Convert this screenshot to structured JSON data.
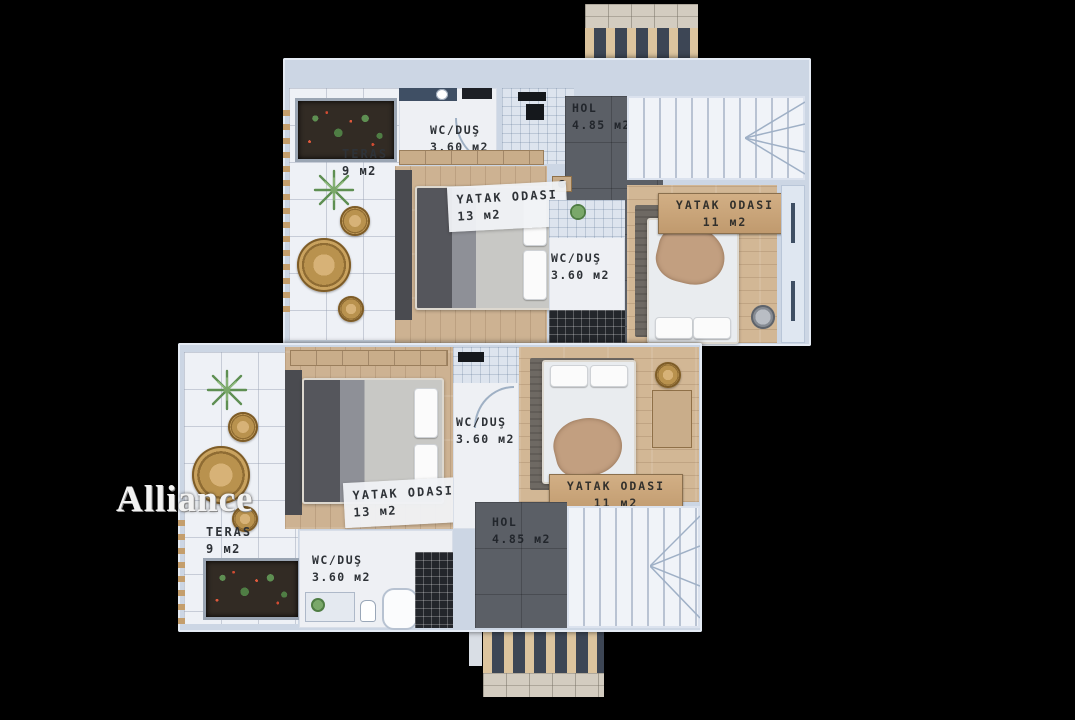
{
  "watermark": "Alliance",
  "floor_plan": {
    "title": "Villa upper floor plan",
    "units": [
      {
        "id": "upper-unit",
        "rooms": [
          {
            "name": "TERAS",
            "area": "9 м2"
          },
          {
            "name": "WC/DUŞ",
            "area": "3.60 м2"
          },
          {
            "name": "HOL",
            "area": "4.85 м2"
          },
          {
            "name": "YATAK ODASI",
            "area": "13 м2"
          },
          {
            "name": "WC/DUŞ",
            "area": "3.60 м2"
          },
          {
            "name": "YATAK ODASI",
            "area": "11 м2"
          }
        ]
      },
      {
        "id": "lower-unit",
        "rooms": [
          {
            "name": "TERAS",
            "area": "9 м2"
          },
          {
            "name": "WC/DUŞ",
            "area": "3.60 м2"
          },
          {
            "name": "HOL",
            "area": "4.85 м2"
          },
          {
            "name": "YATAK ODASI",
            "area": "13 м2"
          },
          {
            "name": "WC/DUŞ",
            "area": "3.60 м2"
          },
          {
            "name": "YATAK ODASI",
            "area": "11 м2"
          }
        ]
      }
    ]
  },
  "colors": {
    "background": "#000000",
    "wall": "#ccd6e4",
    "wood_floor": "#cdb292",
    "dark_floor": "#5b5f66",
    "terrace_tile": "#eef1f6",
    "wood_badge": "#c9a87d",
    "navy_accent": "#3f4f64",
    "label_text": "#2e3237",
    "louver_wood": "#dcc49e",
    "louver_dark": "#3d4655"
  }
}
